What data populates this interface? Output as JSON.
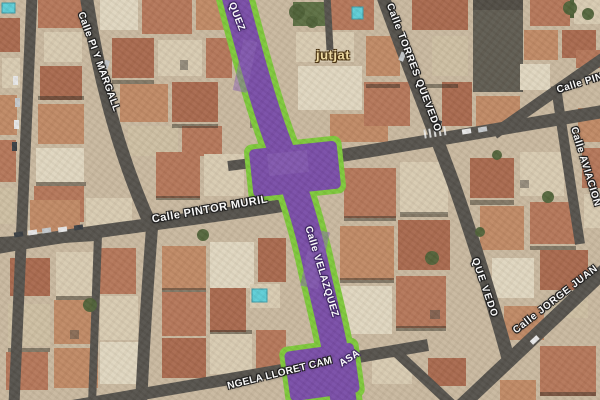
{
  "map": {
    "street_labels": [
      {
        "id": "pi-y-margall",
        "text": "Calle PI Y MARGALL"
      },
      {
        "id": "pintor-murillo",
        "text": "Calle PINTOR MURIL"
      },
      {
        "id": "torres-quevedo",
        "text": "Calle TORRES QUEVEDO"
      },
      {
        "id": "quevedo",
        "text": "QUE VEDO"
      },
      {
        "id": "pintor-right",
        "text": "Calle PIN"
      },
      {
        "id": "aviacion",
        "text": "Calle AVIACION"
      },
      {
        "id": "jorge-juan",
        "text": "Calle JORGE JUAN"
      },
      {
        "id": "lloret-camarasa",
        "text": "NGELA LLORET CAM"
      }
    ],
    "place_labels": [
      {
        "id": "jutjat",
        "text": "jutjat",
        "color": "#f2dda4"
      }
    ],
    "route": {
      "name_fragment_top": "QUEZ",
      "name_mid": "Calle VELAZQUEZ",
      "name_fragment_bottom": "ASA",
      "fill": "#7a4ea8",
      "border": "#7fc93c",
      "label_color": "#ffffff"
    },
    "colors": {
      "street_label_text": "#ffffff",
      "street_label_outline": "#1c1c1c",
      "asphalt": "#56534d",
      "ground": "#c9b9a0"
    }
  }
}
